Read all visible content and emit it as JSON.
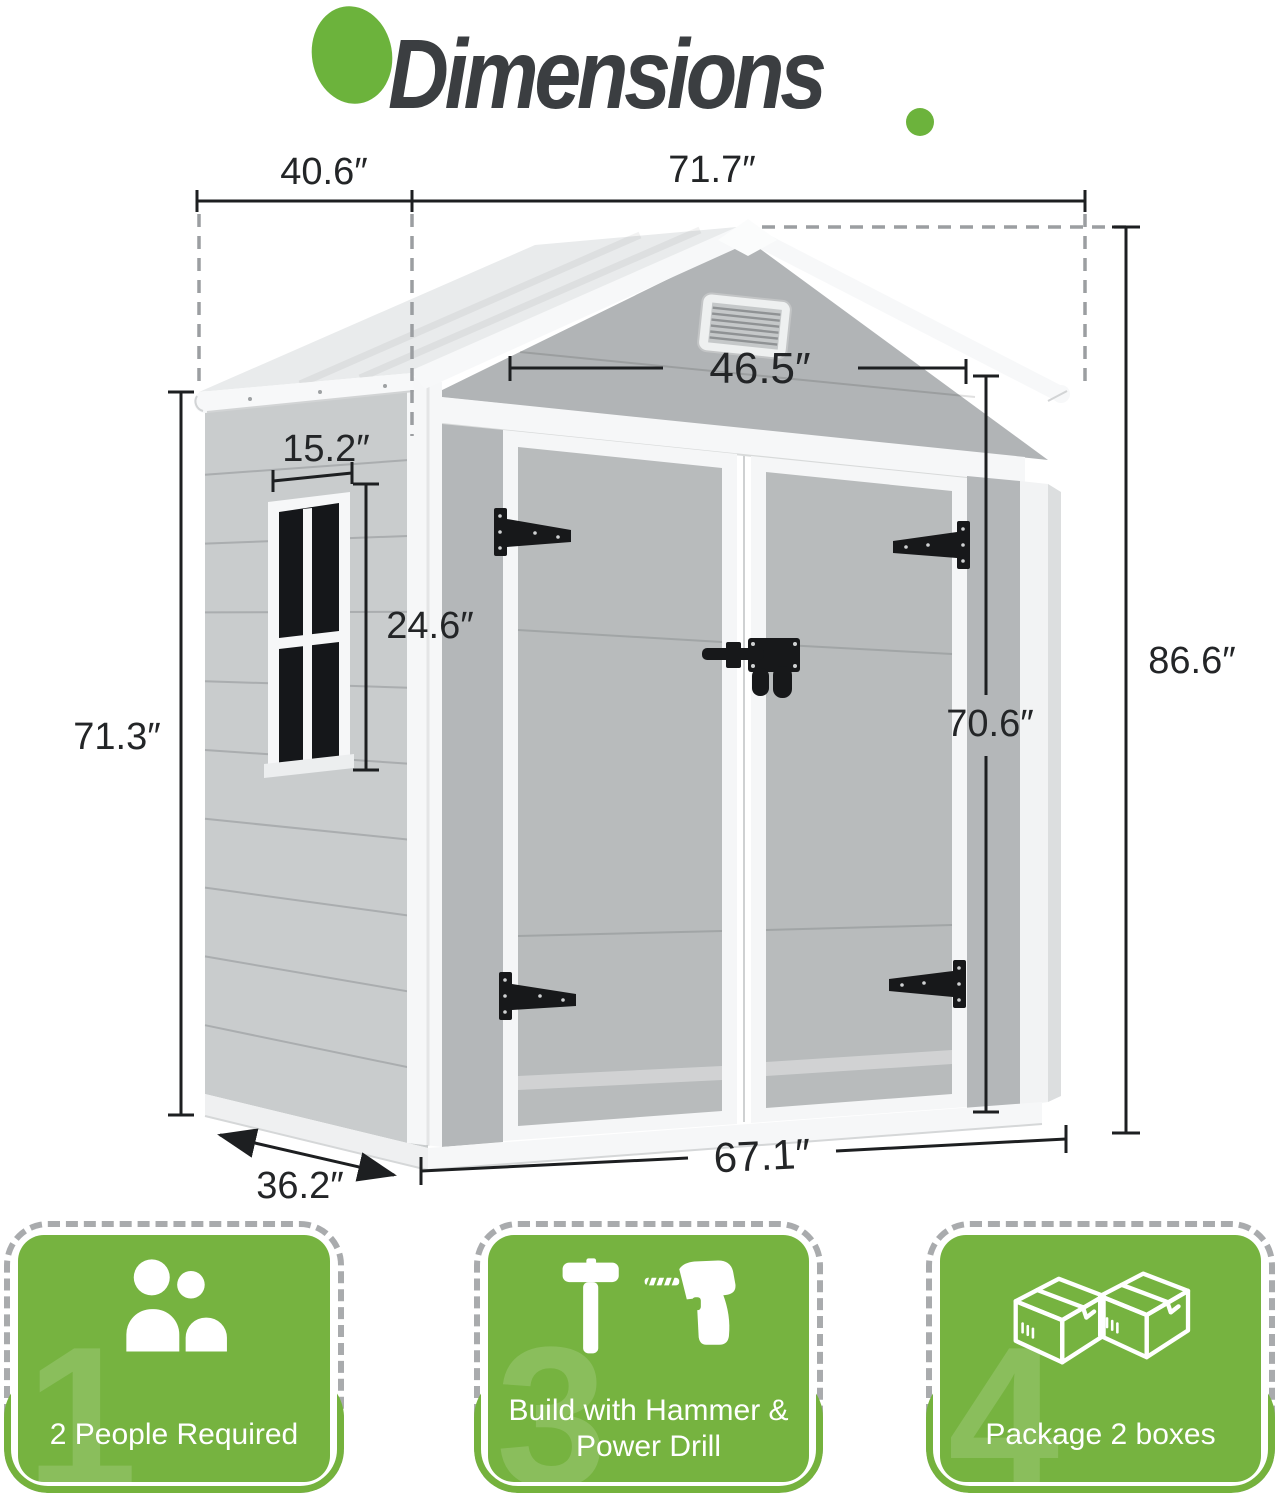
{
  "title": {
    "text": "Dimensions"
  },
  "colors": {
    "accent_green": "#6cb33c",
    "card_green": "#76b340",
    "dim_line": "#1d1f21",
    "dash_gray": "#9b9ea1",
    "title_text": "#3b3e41",
    "shed_wall": "#c9cccd",
    "shed_front": "#b1b4b6",
    "shed_roof": "#e9ebec",
    "shed_trim": "#f6f7f8"
  },
  "dimensions": {
    "roof_depth": "40.6″",
    "roof_width": "71.7″",
    "door_width": "46.5″",
    "window_width": "15.2″",
    "window_height": "24.6″",
    "wall_height": "71.3″",
    "total_height": "86.6″",
    "door_height": "70.6″",
    "base_width": "67.1″",
    "base_depth": "36.2″"
  },
  "cards": [
    {
      "label": "2 People Required",
      "watermark": "1",
      "icon": "two-people-icon"
    },
    {
      "label_line1": "Build with Hammer &",
      "label_line2": "Power Drill",
      "watermark": "3",
      "icon": "hammer-and-drill-icon"
    },
    {
      "label": "Package 2 boxes",
      "watermark": "4",
      "icon": "two-boxes-icon"
    }
  ],
  "icons": {
    "title_blob": "green-circle",
    "title_dot": "green-dot",
    "card1": "two-people-icon",
    "card2": "hammer-and-drill-icon",
    "card3": "two-boxes-icon"
  }
}
